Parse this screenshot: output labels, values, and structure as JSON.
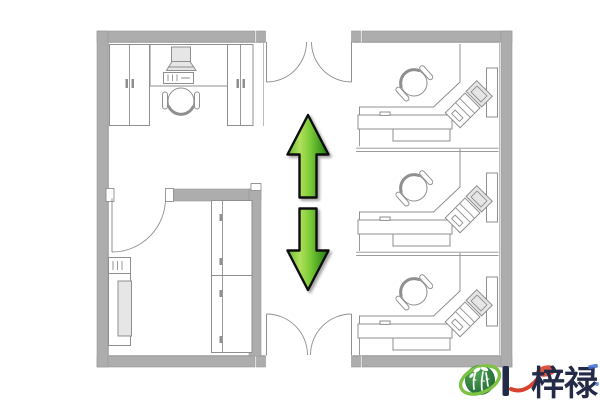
{
  "canvas": {
    "width": 600,
    "height": 400,
    "background": "#ffffff"
  },
  "colors": {
    "wall": "#adadad",
    "wall_edge": "#989898",
    "line": "#8f8f8f",
    "line_light": "#bdbdbd",
    "fill_light": "#e6e6e6",
    "arrow_outline": "#0e0e0e",
    "arrow_green_light": "#b2e05c",
    "arrow_green_mid": "#63b932",
    "arrow_green_mid2": "#7ccb37",
    "arrow_green_dark": "#1c7a10",
    "logo_green_light": "#4fa854",
    "logo_green_dark": "#1b5e2f",
    "logo_ring": "#7cc243",
    "brand_text": "#242b47",
    "accent_red": "#d8422e",
    "accent_blue": "#3f6fd1"
  },
  "watermark": {
    "brand": "梓禄",
    "divider": "|",
    "logo": "green-globe-bamboo-logo"
  },
  "icons": {
    "arrow_up": "green-arrow-up",
    "arrow_down": "green-arrow-down"
  }
}
